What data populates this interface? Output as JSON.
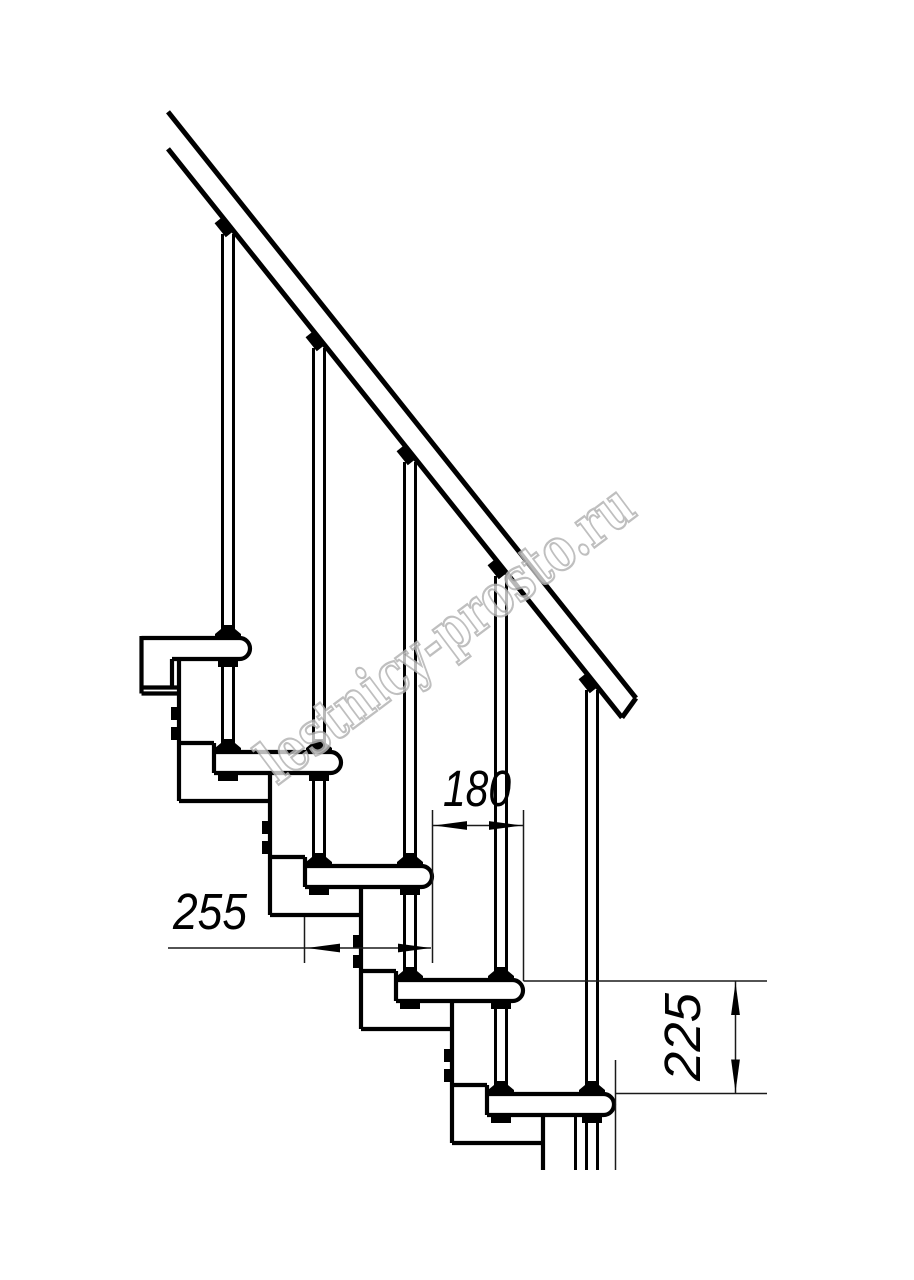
{
  "page": {
    "background": "#ffffff",
    "width": 914,
    "height": 1280
  },
  "drawing": {
    "kind": "modular-staircase-side-elevation",
    "line_color": "#000000",
    "dim_color": "#1a1a1a",
    "dimensions": [
      {
        "id": "tread-depth",
        "label": "255",
        "orientation": "horizontal"
      },
      {
        "id": "step-run",
        "label": "180",
        "orientation": "horizontal"
      },
      {
        "id": "step-rise",
        "label": "225",
        "orientation": "vertical"
      }
    ],
    "watermark": {
      "text": "lestnicy-prosto.ru",
      "stroke_color": "#b4b4b4",
      "fill_color": "#ffffff",
      "angle_deg": -36.9
    },
    "geometry": {
      "steps": 5,
      "tread_left_x_step3": 305,
      "tread_top_y_step3": 866,
      "run_px": 91,
      "rise_px": 114,
      "tread_len_px": 127,
      "tread_thick_px": 21,
      "module_offset_px": 56,
      "module_drop_px": 163,
      "baluster_offset_px": 105,
      "baluster_len_px": 404,
      "rail_gap_px": 37,
      "rail_slope": 1.2527,
      "rail_start_x": 168,
      "rail_end_x": 636,
      "bottom_cut_y": 1170
    }
  }
}
